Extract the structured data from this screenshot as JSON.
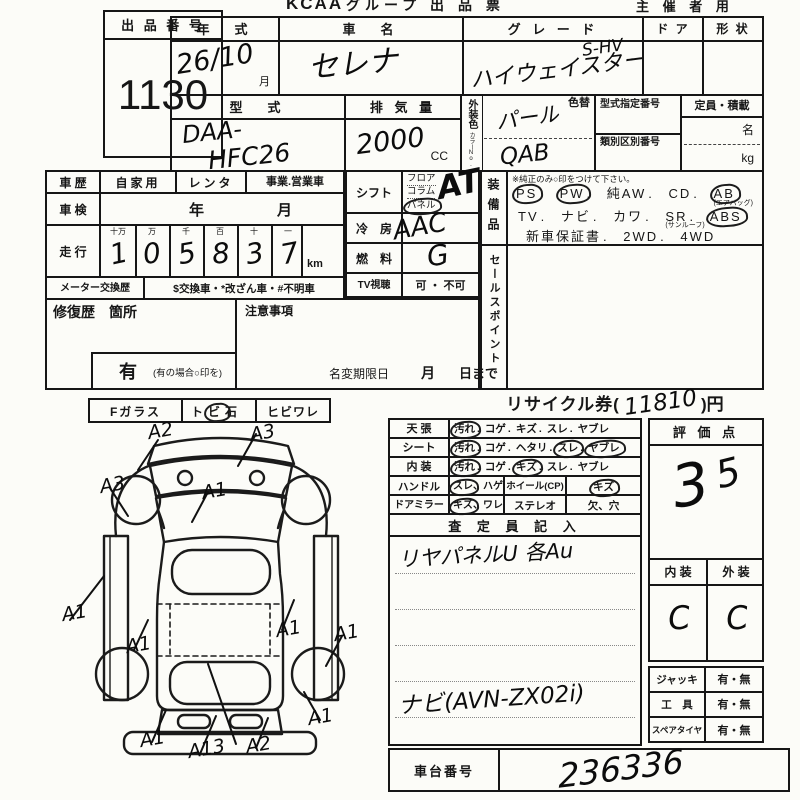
{
  "punct": {
    "dot": ".",
    "comma": "、"
  },
  "header": {
    "brand": "KCAA",
    "title": "グループ 出 品 票",
    "right": "主 催 者 用"
  },
  "lot": {
    "label": "出 品 番 号",
    "number": "1130"
  },
  "top": {
    "year_label": "年　式",
    "year_value": "26/10",
    "year_unit": "月",
    "name_label": "車　名",
    "name_value": "セレナ",
    "grade_label": "グ レ ー ド",
    "grade_value": "ハイウェイスター",
    "grade_sup": "S-HV",
    "door_label": "ド ア",
    "shape_label": "形 状",
    "model_label": "型　式",
    "model_value_line1": "DAA-",
    "model_value_line2": "HFC26",
    "disp_label": "排 気 量",
    "disp_value": "2000",
    "disp_unit": "CC",
    "ext_color_label": "外装色",
    "ext_color_sub": "カラーNo.",
    "color_change_label": "色替",
    "color_value": "パール",
    "color_code": "QAB",
    "typeno_label": "型式指定番号",
    "classno_label": "類別区別番号",
    "cap_label": "定員・積載",
    "cap_unit_persons": "名",
    "cap_unit_kg": "kg"
  },
  "left": {
    "history_label": "車 歴",
    "history_opts": [
      "自家用",
      "レンタ",
      "事業.営業車"
    ],
    "inspect_label": "車 検",
    "inspect_year": "年",
    "inspect_month": "月",
    "run_label": "走 行",
    "digit_headers": [
      "十万",
      "万",
      "千",
      "百",
      "十",
      "一"
    ],
    "digits": [
      "1",
      "0",
      "5",
      "8",
      "3",
      "7"
    ],
    "run_unit": "km",
    "meter_label": "メーター交換歴",
    "meter_opts": "$交換車・*改ざん車・#不明車",
    "repair_label": "修復歴　箇所",
    "repair_yes": "有",
    "repair_note": "(有の場合○印を)",
    "caution_label": "注意事項",
    "namechange_label": "名変期限日",
    "namechange_month": "月",
    "namechange_day": "日まで"
  },
  "mid": {
    "shift_label": "シフト",
    "shift_opts": [
      "フロア",
      "コラム",
      "パネル"
    ],
    "shift_value": "AT",
    "cool_label": "冷　房",
    "cool_value": "AAC",
    "fuel_label": "燃　料",
    "fuel_value": "G",
    "tv_label": "TV視聴",
    "tv_opts": "可 ・ 不可"
  },
  "equip": {
    "label": "装備品",
    "note": "※純正のみ○印をつけて下さい。",
    "line1": [
      {
        "t": "PS",
        "circled": true
      },
      {
        "t": "PW",
        "circled": true
      },
      {
        "t": "純AW",
        "circled": false
      },
      {
        "t": "CD",
        "circled": false
      },
      {
        "t": "AB",
        "circled": true,
        "sub": "(エアバッグ)"
      }
    ],
    "line2": [
      {
        "t": "TV",
        "circled": false
      },
      {
        "t": "ナビ",
        "circled": false
      },
      {
        "t": "カワ",
        "circled": false
      },
      {
        "t": "SR",
        "circled": false,
        "sub": "(サンルーフ)"
      },
      {
        "t": "ABS",
        "circled": true
      }
    ],
    "line3": [
      {
        "t": "新車保証書",
        "circled": false
      },
      {
        "t": "2WD",
        "circled": false
      },
      {
        "t": "4WD",
        "circled": false
      }
    ]
  },
  "sales": {
    "label": "セールスポイント",
    "value": ""
  },
  "recycle": {
    "prefix": "リサイクル券(",
    "value": "11810",
    "suffix": ")円"
  },
  "glass": {
    "label": "Fガラス",
    "opt1_pre": "ト",
    "opt1_circled": "ビ",
    "opt1_post": "石",
    "opt2": "ヒビワレ"
  },
  "condition": {
    "rows": [
      {
        "label": "天 張",
        "opts": [
          {
            "t": "汚れ",
            "circled": true
          },
          {
            "t": "コゲ",
            "circled": false
          },
          {
            "t": "キズ",
            "circled": false
          },
          {
            "t": "スレ",
            "circled": false
          },
          {
            "t": "ヤブレ",
            "circled": false
          }
        ]
      },
      {
        "label": "シート",
        "opts": [
          {
            "t": "汚れ",
            "circled": true
          },
          {
            "t": "コゲ",
            "circled": false
          },
          {
            "t": "ヘタリ",
            "circled": false
          },
          {
            "t": "スレ",
            "circled": true
          },
          {
            "t": "ヤブレ",
            "circled": true
          }
        ]
      },
      {
        "label": "内 装",
        "opts": [
          {
            "t": "汚れ",
            "circled": true
          },
          {
            "t": "コゲ",
            "circled": false
          },
          {
            "t": "キズ",
            "circled": true
          },
          {
            "t": "スレ",
            "circled": false
          },
          {
            "t": "ヤブレ",
            "circled": false
          }
        ]
      }
    ],
    "handle_label": "ハンドル",
    "handle_opt1": "スレ",
    "handle_opt2": "ハゲ",
    "wheel_label": "ホイール(CP)",
    "wheel_opt": "キズ",
    "mirror_label": "ドアミラー",
    "mirror_opt1": "キズ",
    "mirror_opt2": "ワレ",
    "stereo_label": "ステレオ",
    "stereo_opt": "欠、穴"
  },
  "assessor": {
    "header": "査 定 員 記 入",
    "line1": "リヤパネルU 各Au",
    "line2": "ナビ(AVN-ZX02i)"
  },
  "score": {
    "label": "評 価 点",
    "value": "3.5",
    "digit_main": "3",
    "digit_sub": "5",
    "interior_label": "内 装",
    "exterior_label": "外 装",
    "interior_value": "C",
    "exterior_value": "C"
  },
  "accessories": {
    "rows": [
      {
        "label": "ジャッキ",
        "opts": "有・無"
      },
      {
        "label": "工　具",
        "opts": "有・無"
      },
      {
        "label": "スペアタイヤ",
        "opts": "有・無"
      }
    ]
  },
  "chassis": {
    "label": "車台番号",
    "value": "236336"
  },
  "marks": {
    "m1": "A2",
    "m2": "A3",
    "m3": "A3",
    "m4": "A1",
    "m5": "A1",
    "m6": "A1",
    "m7": "A1",
    "m8": "A1",
    "m9": "A1",
    "m10": "A13",
    "m11": "A2",
    "m12": "A1"
  }
}
